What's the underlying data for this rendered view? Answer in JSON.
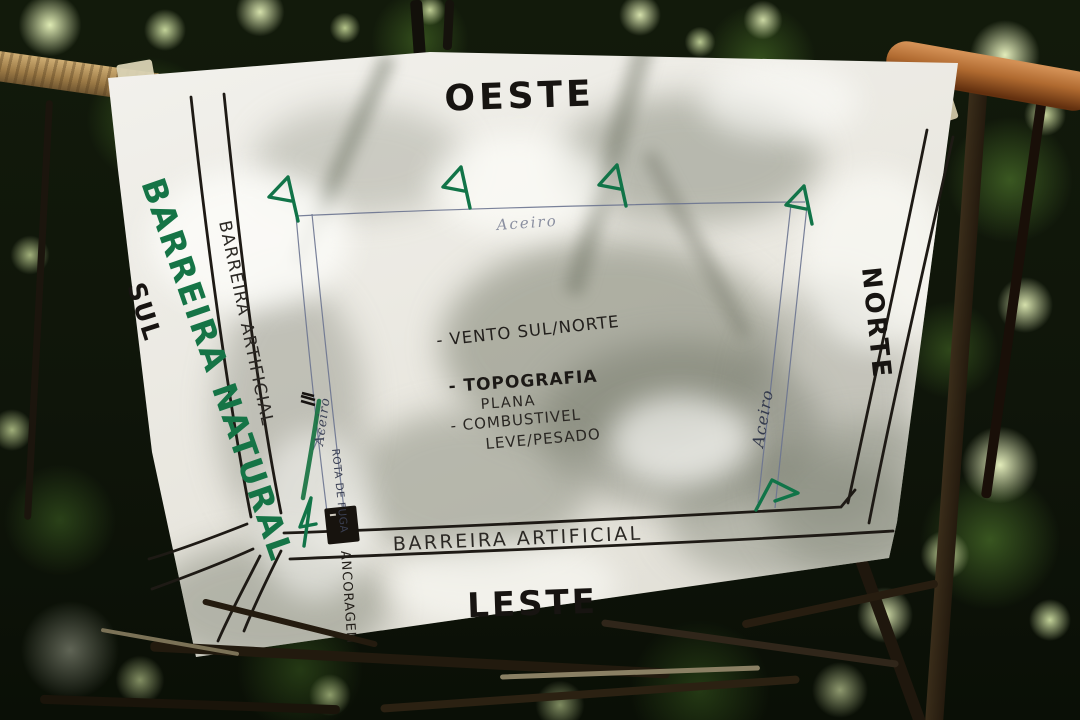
{
  "map": {
    "cardinals": {
      "west": "OESTE",
      "north": "NORTE",
      "south": "SUL",
      "east": "LESTE"
    },
    "labels": {
      "natural_barrier": "BARREIRA NATURAL",
      "artificial_barrier_left": "BARREIRA ARTIFICIAL",
      "artificial_barrier_bottom": "BARREIRA ARTIFICIAL",
      "firebreak_top": "Aceiro",
      "firebreak_left": "Aceiro",
      "firebreak_right": "Aceiro",
      "escape_route": "ROTA DE FUGA",
      "anchor_point": "ANCORAGEM"
    },
    "annotations": {
      "wind": "- VENTO SUL/NORTE",
      "topography_label": "- TOPOGRAFIA",
      "topography_value": "PLANA",
      "fuel_label": "- COMBUSTIVEL",
      "fuel_value": "LEVE/PESADO"
    },
    "colors": {
      "marker_green": "#157446",
      "ink_black": "#221e19",
      "pencil_blue": "#6b7490",
      "paper_white": "#e9e7e0"
    }
  }
}
